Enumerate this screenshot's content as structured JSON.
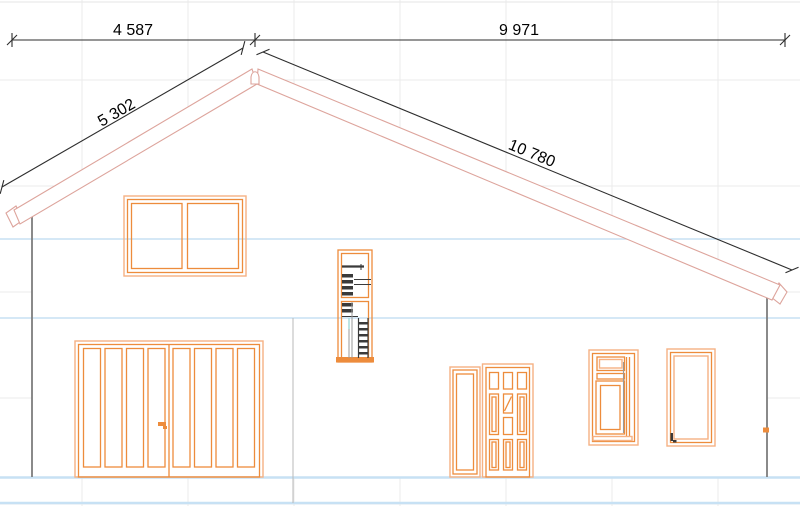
{
  "dimensions": {
    "top_left": "4 587",
    "top_right": "9 971",
    "roof_left": "5 302",
    "roof_right": "10 780"
  },
  "colors": {
    "frame_orange": "#ed8c3c",
    "frame_orange_light": "#f6b183",
    "roof_salmon": "#dda49c",
    "story_line_blue": "#c7e1f4",
    "grid_gray": "#ebebeb",
    "wall_gray": "#7d7d7d",
    "dimension_black": "#2d2d2d",
    "detail_dark": "#3a3a3a",
    "detail_cyan": "#a7dcdc"
  }
}
